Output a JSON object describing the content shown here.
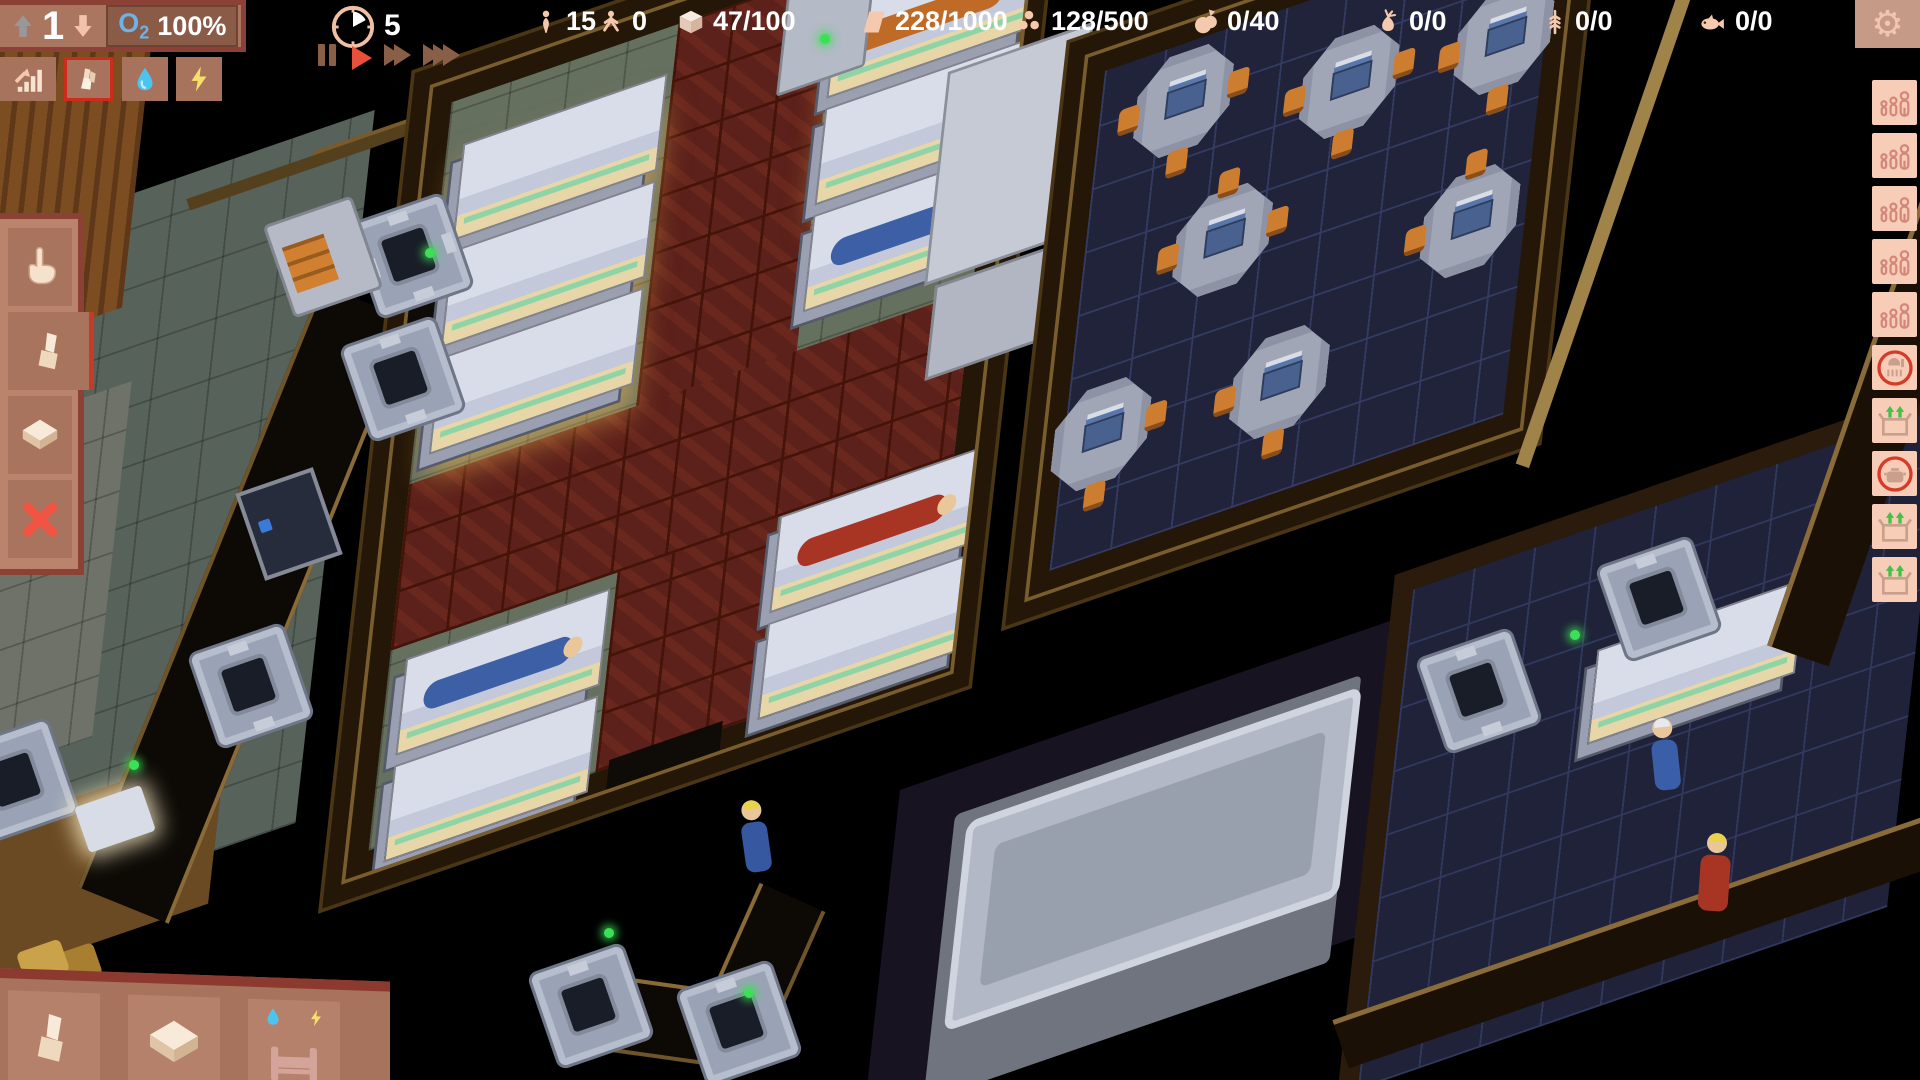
{
  "hud": {
    "level_panel": {
      "level": "1",
      "o2_label": "O",
      "o2_sub": "2",
      "o2_value": "100%",
      "up_icon": "level-up-arrow-icon",
      "down_icon": "level-down-arrow-icon"
    },
    "clock": {
      "icon": "clock-icon",
      "value": "5"
    },
    "resources": [
      {
        "id": "colonists",
        "icon": "person-icon",
        "value": "15"
      },
      {
        "id": "children",
        "icon": "child-icon",
        "value": "0"
      },
      {
        "id": "storage-crates",
        "icon": "crate-icon",
        "value": "47/100"
      },
      {
        "id": "building-panels",
        "icon": "panel-icon",
        "value": "228/1000"
      },
      {
        "id": "ore",
        "icon": "ore-icon",
        "value": "128/500"
      },
      {
        "id": "fruit",
        "icon": "fruit-icon",
        "value": "0/40"
      },
      {
        "id": "vegetables",
        "icon": "vegetable-icon",
        "value": "0/0"
      },
      {
        "id": "wheat",
        "icon": "wheat-icon",
        "value": "0/0"
      },
      {
        "id": "fish",
        "icon": "fish-icon",
        "value": "0/0"
      }
    ],
    "settings": {
      "icon": "gear-icon"
    }
  },
  "speed_controls": {
    "buttons": [
      {
        "id": "pause",
        "icon": "pause-icon",
        "active": false
      },
      {
        "id": "play",
        "icon": "play-icon",
        "active": true
      },
      {
        "id": "fast-forward",
        "icon": "fast-forward-icon",
        "active": false
      },
      {
        "id": "fastest",
        "icon": "fastest-icon",
        "active": false
      }
    ]
  },
  "quickbar": {
    "items": [
      {
        "id": "stats",
        "icon": "stats-icon",
        "selected": false
      },
      {
        "id": "build",
        "icon": "build-icon",
        "selected": true
      },
      {
        "id": "water",
        "icon": "water-icon",
        "selected": false
      },
      {
        "id": "power",
        "icon": "power-icon",
        "selected": false
      }
    ]
  },
  "tool_panel": {
    "items": [
      {
        "id": "select",
        "icon": "hand-icon",
        "selected": false
      },
      {
        "id": "build-wall",
        "icon": "wall-icon",
        "selected": true
      },
      {
        "id": "build-floor",
        "icon": "floor-icon",
        "selected": false
      },
      {
        "id": "cancel",
        "icon": "cancel-x-icon",
        "selected": false
      }
    ]
  },
  "build_panel": {
    "items": [
      {
        "id": "wall",
        "icon": "wall-icon"
      },
      {
        "id": "floor",
        "icon": "floor-icon"
      },
      {
        "id": "bed",
        "icon": "bed-icon",
        "overlays": [
          "water-drop-icon",
          "power-bolt-icon"
        ]
      }
    ]
  },
  "sidebar": {
    "items": [
      {
        "id": "population-group-1",
        "icon": "family-icon"
      },
      {
        "id": "population-group-2",
        "icon": "family-icon"
      },
      {
        "id": "population-group-3",
        "icon": "family-icon"
      },
      {
        "id": "population-group-4",
        "icon": "family-icon"
      },
      {
        "id": "population-group-5",
        "icon": "family-icon"
      },
      {
        "id": "habitat",
        "icon": "habitat-circle-icon"
      },
      {
        "id": "supply-box-1",
        "icon": "supply-box-icon"
      },
      {
        "id": "kitchen",
        "icon": "cooking-pot-circle-icon"
      },
      {
        "id": "supply-box-2",
        "icon": "supply-box-icon"
      },
      {
        "id": "supply-box-3",
        "icon": "supply-box-icon"
      }
    ]
  },
  "colors": {
    "accent_red": "#d8402b",
    "hud_brown": "#a8735c",
    "hud_maroon": "#8c4136",
    "icon_salmon": "#f5c9ae",
    "led_green": "#3ce056",
    "o2_blue": "#6cb4e8",
    "sidebar_tile": "#f7cdb8",
    "carpet_red": "#5c211b",
    "dining_floor": "#20233a"
  },
  "scene": {
    "rooms": [
      {
        "name": "corridor"
      },
      {
        "name": "dormitory"
      },
      {
        "name": "dining-hall"
      },
      {
        "name": "storage-room"
      }
    ]
  }
}
